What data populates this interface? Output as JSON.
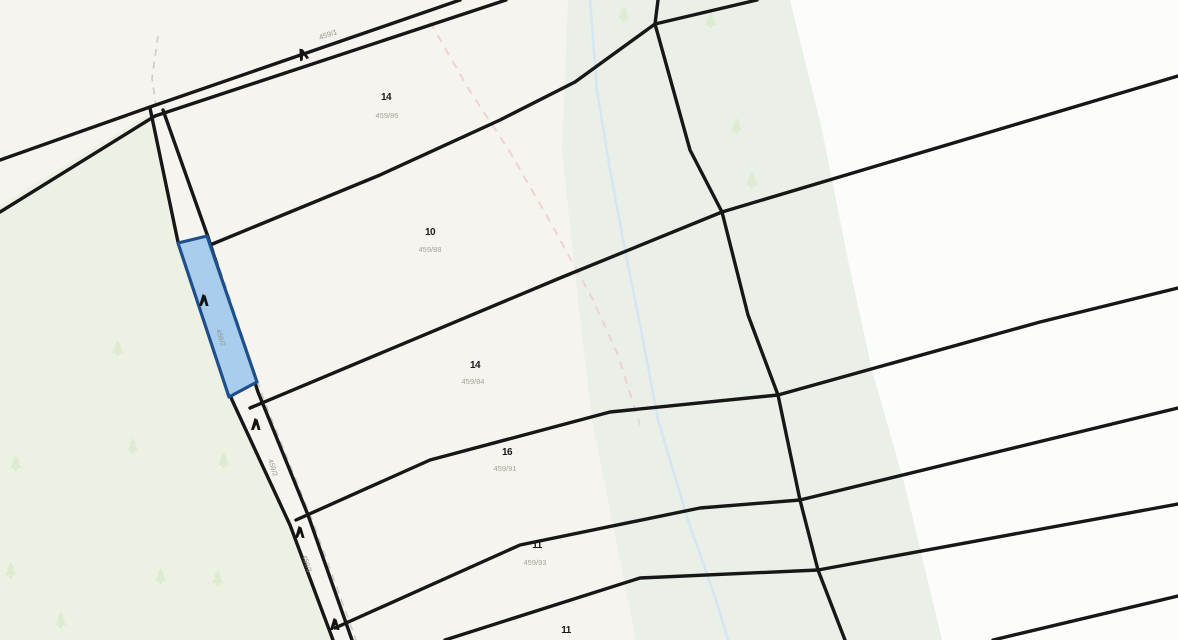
{
  "map": {
    "width": 1178,
    "height": 640,
    "colors": {
      "base_cream": "#f6f4ee",
      "white_parcels": "#fcfcfa",
      "forest_green": "#ecf1e4",
      "corridor_green": "#e9eee6",
      "boundary_black": "#171717",
      "highlight_fill": "#a9cdec",
      "highlight_stroke": "#1f4f8a",
      "stream_blue": "#d3e4f4",
      "trail_pink": "#eecdca",
      "trail_gray": "#c9c8c0",
      "tree_green": "#dcead0",
      "marker_black": "#141414",
      "label_gray": "#9b998e"
    },
    "regions": [
      {
        "name": "white-parcels-east",
        "fill": "#fcfcfa",
        "points": [
          [
            658,
            0
          ],
          [
            1178,
            0
          ],
          [
            1178,
            640
          ],
          [
            845,
            640
          ],
          [
            818,
            570
          ],
          [
            800,
            500
          ],
          [
            778,
            395
          ],
          [
            748,
            315
          ],
          [
            722,
            212
          ],
          [
            690,
            150
          ],
          [
            655,
            24
          ]
        ]
      },
      {
        "name": "riparian-corridor-band",
        "fill": "#e9eee6",
        "opacity": 0.95,
        "points": [
          [
            568,
            0
          ],
          [
            790,
            0
          ],
          [
            822,
            130
          ],
          [
            848,
            260
          ],
          [
            872,
            370
          ],
          [
            906,
            490
          ],
          [
            942,
            640
          ],
          [
            636,
            640
          ],
          [
            612,
            520
          ],
          [
            592,
            420
          ],
          [
            578,
            300
          ],
          [
            562,
            150
          ]
        ]
      },
      {
        "name": "forest-area-west",
        "fill": "#ecf1e4",
        "points": [
          [
            0,
            205
          ],
          [
            152,
            112
          ],
          [
            178,
            242
          ],
          [
            232,
            400
          ],
          [
            290,
            525
          ],
          [
            333,
            640
          ],
          [
            0,
            640
          ]
        ]
      }
    ],
    "water_path": {
      "name": "stream",
      "color": "#d3e4f4",
      "width": 2.5,
      "opacity": 0.9,
      "points": [
        [
          590,
          0
        ],
        [
          597,
          90
        ],
        [
          610,
          170
        ],
        [
          626,
          255
        ],
        [
          643,
          340
        ],
        [
          658,
          420
        ],
        [
          688,
          520
        ],
        [
          716,
          600
        ],
        [
          728,
          640
        ]
      ]
    },
    "trails": [
      {
        "name": "footpath-pink-dashed",
        "color": "#eecdca",
        "width": 2,
        "dash": "8 7",
        "opacity": 0.85,
        "points": [
          [
            430,
            22
          ],
          [
            468,
            88
          ],
          [
            510,
            152
          ],
          [
            552,
            225
          ],
          [
            592,
            298
          ],
          [
            618,
            355
          ],
          [
            640,
            425
          ]
        ]
      },
      {
        "name": "track-gray-dashed-upper",
        "color": "#c9c8c0",
        "width": 1.6,
        "dash": "7 6",
        "opacacity": 0.9,
        "points": [
          [
            158,
            36
          ],
          [
            152,
            78
          ],
          [
            156,
            106
          ]
        ]
      },
      {
        "name": "track-gray-dashed-lower",
        "color": "#c9c8c0",
        "width": 1.6,
        "dash": "7 6",
        "opacity": 0.9,
        "points": [
          [
            172,
            135
          ],
          [
            212,
            245
          ],
          [
            264,
            400
          ],
          [
            314,
            525
          ],
          [
            356,
            640
          ]
        ]
      }
    ],
    "boundaries": [
      {
        "name": "road-edge-north",
        "points": [
          [
            0,
            160
          ],
          [
            150,
            107
          ],
          [
            460,
            0
          ]
        ]
      },
      {
        "name": "road-edge-south",
        "points": [
          [
            0,
            212
          ],
          [
            155,
            116
          ],
          [
            506,
            0
          ]
        ]
      },
      {
        "name": "lane-edge-west",
        "points": [
          [
            150,
            108
          ],
          [
            178,
            242
          ],
          [
            232,
            400
          ],
          [
            290,
            525
          ],
          [
            333,
            640
          ]
        ]
      },
      {
        "name": "lane-edge-east",
        "points": [
          [
            163,
            110
          ],
          [
            208,
            237
          ],
          [
            258,
            392
          ],
          [
            308,
            515
          ],
          [
            352,
            640
          ]
        ]
      },
      {
        "name": "parcel-boundary-a",
        "points": [
          [
            210,
            245
          ],
          [
            380,
            175
          ],
          [
            500,
            120
          ],
          [
            575,
            82
          ],
          [
            655,
            24
          ]
        ]
      },
      {
        "name": "main-north-south-boundary",
        "points": [
          [
            658,
            0
          ],
          [
            655,
            24
          ],
          [
            690,
            150
          ],
          [
            722,
            212
          ],
          [
            748,
            315
          ],
          [
            778,
            395
          ],
          [
            800,
            500
          ],
          [
            818,
            570
          ],
          [
            845,
            640
          ]
        ]
      },
      {
        "name": "parcel-boundary-top",
        "points": [
          [
            655,
            24
          ],
          [
            757,
            0
          ]
        ]
      },
      {
        "name": "parcel-boundary-b",
        "points": [
          [
            250,
            408
          ],
          [
            560,
            278
          ],
          [
            722,
            212
          ],
          [
            1178,
            76
          ]
        ]
      },
      {
        "name": "parcel-boundary-c",
        "points": [
          [
            296,
            520
          ],
          [
            430,
            460
          ],
          [
            610,
            412
          ],
          [
            778,
            395
          ],
          [
            1040,
            322
          ],
          [
            1178,
            288
          ]
        ]
      },
      {
        "name": "parcel-boundary-d",
        "points": [
          [
            335,
            628
          ],
          [
            520,
            545
          ],
          [
            700,
            508
          ],
          [
            800,
            500
          ],
          [
            1178,
            408
          ]
        ]
      },
      {
        "name": "parcel-boundary-e",
        "points": [
          [
            445,
            640
          ],
          [
            640,
            578
          ],
          [
            818,
            570
          ],
          [
            1178,
            504
          ]
        ]
      },
      {
        "name": "parcel-boundary-f",
        "points": [
          [
            993,
            640
          ],
          [
            1178,
            596
          ]
        ]
      }
    ],
    "boundary_style": {
      "width": 3.4
    },
    "highlight_parcel": {
      "name": "selected-parcel",
      "points": [
        [
          178,
          243
        ],
        [
          207,
          236
        ],
        [
          257,
          382
        ],
        [
          229,
          397
        ]
      ],
      "marker": {
        "x": 199,
        "y": 294
      },
      "label": {
        "text": "459/2",
        "x": 216,
        "y": 330,
        "rotation": 72
      }
    },
    "trees": [
      {
        "x": 112,
        "y": 340
      },
      {
        "x": 10,
        "y": 455
      },
      {
        "x": 127,
        "y": 438
      },
      {
        "x": 218,
        "y": 452
      },
      {
        "x": 5,
        "y": 562
      },
      {
        "x": 155,
        "y": 568
      },
      {
        "x": 212,
        "y": 570
      },
      {
        "x": 55,
        "y": 612
      },
      {
        "x": 731,
        "y": 118
      },
      {
        "x": 746,
        "y": 172
      },
      {
        "x": 705,
        "y": 12
      },
      {
        "x": 618,
        "y": 6
      }
    ],
    "survey_markers": [
      {
        "x": 296,
        "y": 50,
        "rotation": -20
      },
      {
        "x": 251,
        "y": 418,
        "rotation": 0
      },
      {
        "x": 295,
        "y": 526,
        "rotation": 0
      },
      {
        "x": 330,
        "y": 618,
        "rotation": 0
      }
    ],
    "parcel_labels": [
      {
        "id_text": "14",
        "sub_text": "459/86",
        "ix": 386,
        "iy": 100,
        "sx": 381,
        "sy": 118
      },
      {
        "id_text": "10",
        "sub_text": "459/88",
        "ix": 430,
        "iy": 235,
        "sx": 424,
        "sy": 252
      },
      {
        "id_text": "14",
        "sub_text": "459/84",
        "ix": 475,
        "iy": 368,
        "sx": 467,
        "sy": 384
      },
      {
        "id_text": "16",
        "sub_text": "459/91",
        "ix": 507,
        "iy": 455,
        "sx": 499,
        "sy": 471
      },
      {
        "id_text": "11",
        "sub_text": "459/93",
        "ix": 537,
        "iy": 548,
        "sx": 529,
        "sy": 565
      },
      {
        "id_text": "11",
        "sub_text": "",
        "ix": 566,
        "iy": 633,
        "sx": 0,
        "sy": 0
      }
    ],
    "road_label": {
      "text": "459/1",
      "x": 320,
      "y": 40,
      "rotation": -19
    },
    "corridor_labels": [
      {
        "text": "459/2",
        "x": 268,
        "y": 460,
        "rotation": 72
      },
      {
        "text": "459/3",
        "x": 302,
        "y": 556,
        "rotation": 72
      }
    ]
  }
}
